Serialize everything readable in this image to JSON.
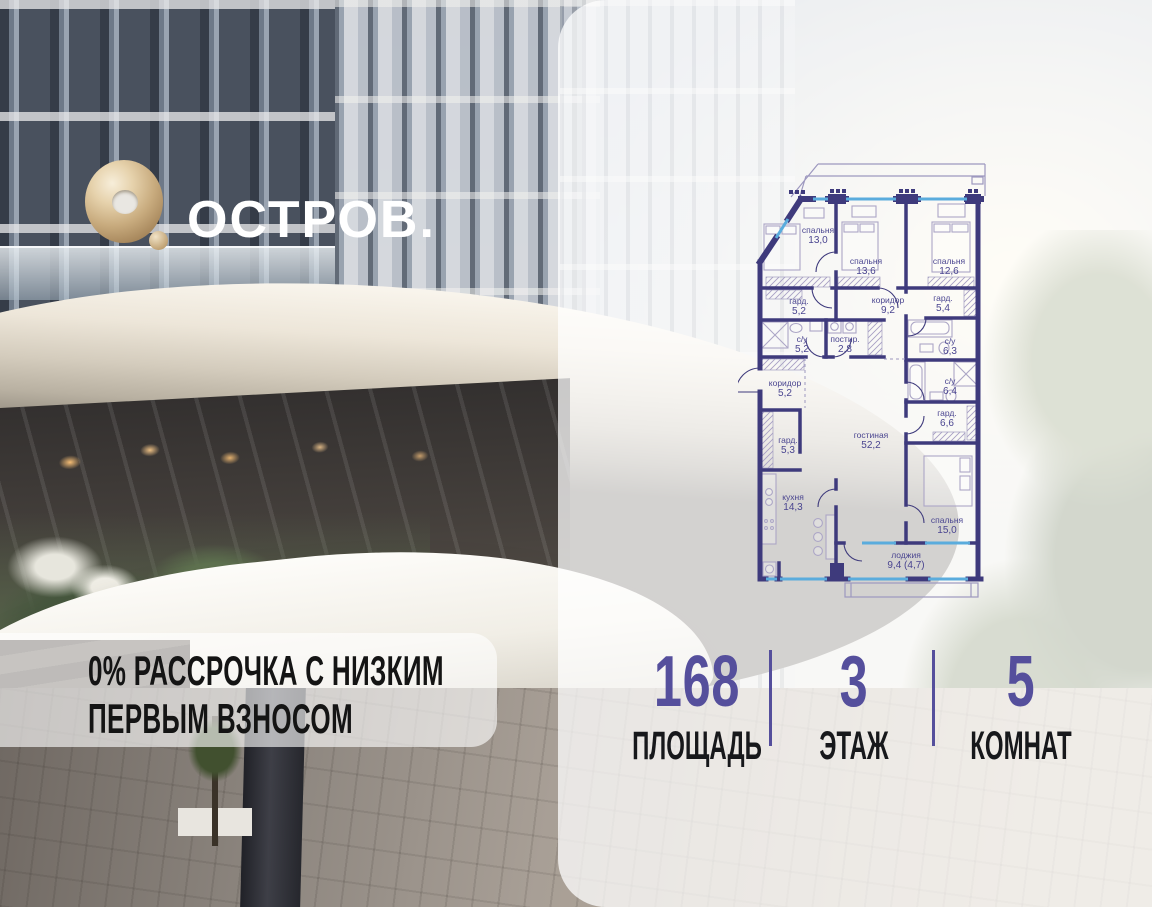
{
  "logo": {
    "wordmark": "ОСТРОВ."
  },
  "banner": {
    "line1": "0% РАССРОЧКА С НИЗКИМ",
    "line2": "ПЕРВЫМ ВЗНОСОМ"
  },
  "stats": {
    "items": [
      {
        "value": "168",
        "label": "ПЛОЩАДЬ"
      },
      {
        "value": "3",
        "label": "ЭТАЖ"
      },
      {
        "value": "5",
        "label": "КОМНАТ"
      }
    ]
  },
  "floor_plan": {
    "rooms": [
      {
        "name": "спальня",
        "area": "13,0",
        "x": 818,
        "y": 236
      },
      {
        "name": "спальня",
        "area": "13,6",
        "x": 866,
        "y": 267
      },
      {
        "name": "спальня",
        "area": "12,6",
        "x": 949,
        "y": 267
      },
      {
        "name": "гард.",
        "area": "5,2",
        "x": 799,
        "y": 307
      },
      {
        "name": "коридор",
        "area": "9,2",
        "x": 888,
        "y": 306
      },
      {
        "name": "гард.",
        "area": "5,4",
        "x": 943,
        "y": 304
      },
      {
        "name": "с/у",
        "area": "5,2",
        "x": 802,
        "y": 345
      },
      {
        "name": "постир.",
        "area": "2,8",
        "x": 845,
        "y": 345
      },
      {
        "name": "с/у",
        "area": "6,3",
        "x": 950,
        "y": 347
      },
      {
        "name": "коридор",
        "area": "5,2",
        "x": 785,
        "y": 389
      },
      {
        "name": "с/у",
        "area": "6,4",
        "x": 950,
        "y": 387
      },
      {
        "name": "гард.",
        "area": "6,6",
        "x": 947,
        "y": 419
      },
      {
        "name": "гард.",
        "area": "5,3",
        "x": 788,
        "y": 446
      },
      {
        "name": "гостиная",
        "area": "52,2",
        "x": 871,
        "y": 441
      },
      {
        "name": "кухня",
        "area": "14,3",
        "x": 793,
        "y": 503
      },
      {
        "name": "спальня",
        "area": "15,0",
        "x": 947,
        "y": 526
      },
      {
        "name": "лоджия",
        "area": "9,4 (4,7)",
        "x": 906,
        "y": 561
      }
    ]
  },
  "colors": {
    "accent_purple": "#554f9c",
    "plan_wall": "#3e3a7c",
    "plan_window": "#5aacdd",
    "plan_label": "#4a4590",
    "logo_gold": "#c8ab7e",
    "stat_label_black": "#17181b"
  }
}
